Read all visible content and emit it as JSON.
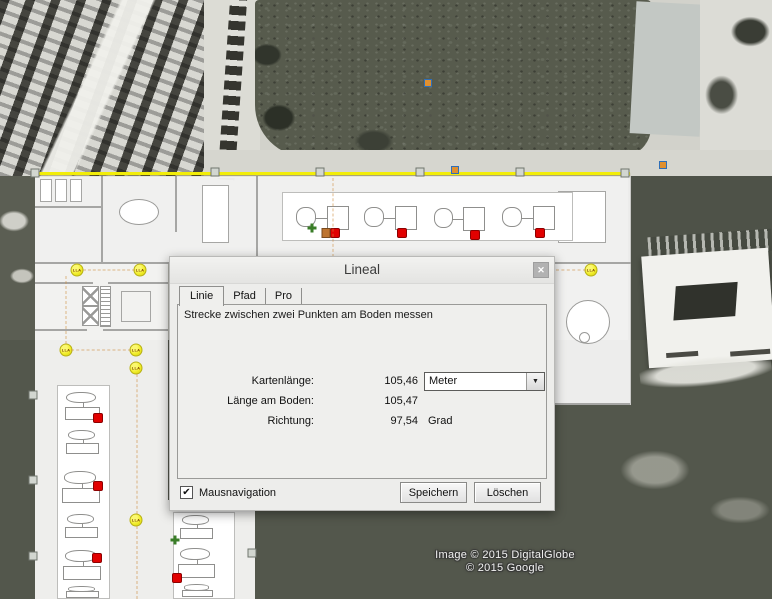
{
  "dialog": {
    "title": "Lineal",
    "close_glyph": "✕",
    "tabs": [
      "Linie",
      "Pfad",
      "Pro"
    ],
    "description": "Strecke zwischen zwei Punkten am Boden messen",
    "fields": [
      {
        "label": "Kartenlänge:",
        "value": "105,46",
        "unit": "Meter"
      },
      {
        "label": "Länge am Boden:",
        "value": "105,47",
        "unit": ""
      },
      {
        "label": "Richtung:",
        "value": "97,54",
        "unit": "Grad"
      }
    ],
    "dropdown_arrow": "▼",
    "checkbox": {
      "label": "Mausnavigation",
      "checked": true,
      "check_glyph": "✔"
    },
    "buttons": [
      "Speichern",
      "Löschen"
    ]
  },
  "map": {
    "attribution": [
      "Image © 2015 DigitalGlobe",
      "© 2015 Google"
    ],
    "ruler_line_color": "#f2ed08",
    "placemark_label": "LLA",
    "annotations": [
      {
        "type": "placemark",
        "label": "LLA",
        "x": 77,
        "y": 270,
        "interactable": true
      },
      {
        "type": "placemark",
        "label": "LLA",
        "x": 140,
        "y": 270,
        "interactable": true
      },
      {
        "type": "placemark",
        "label": "LLA",
        "x": 66,
        "y": 350,
        "interactable": true
      },
      {
        "type": "placemark",
        "label": "LLA",
        "x": 136,
        "y": 350,
        "interactable": true
      },
      {
        "type": "placemark",
        "label": "LLA",
        "x": 136,
        "y": 368,
        "interactable": true
      },
      {
        "type": "placemark",
        "label": "LLA",
        "x": 136,
        "y": 520,
        "interactable": true
      },
      {
        "type": "placemark",
        "label": "LLA",
        "x": 591,
        "y": 270,
        "interactable": true
      },
      {
        "type": "red-dot",
        "x": 335,
        "y": 233
      },
      {
        "type": "red-dot",
        "x": 402,
        "y": 233
      },
      {
        "type": "red-dot",
        "x": 475,
        "y": 235
      },
      {
        "type": "red-dot",
        "x": 540,
        "y": 233
      },
      {
        "type": "red-dot",
        "x": 98,
        "y": 418
      },
      {
        "type": "red-dot",
        "x": 98,
        "y": 486
      },
      {
        "type": "red-dot",
        "x": 97,
        "y": 558
      },
      {
        "type": "red-dot",
        "x": 177,
        "y": 578
      },
      {
        "type": "green-dot",
        "x": 312,
        "y": 228
      },
      {
        "type": "green-dot",
        "x": 175,
        "y": 540
      },
      {
        "type": "orange-dot",
        "x": 326,
        "y": 233
      },
      {
        "type": "blue-dot",
        "x": 428,
        "y": 83
      },
      {
        "type": "blue-dot",
        "x": 455,
        "y": 170
      },
      {
        "type": "blue-dot",
        "x": 663,
        "y": 165
      },
      {
        "type": "handle",
        "x": 35,
        "y": 173,
        "interactable": true
      },
      {
        "type": "handle",
        "x": 215,
        "y": 172,
        "interactable": true
      },
      {
        "type": "handle",
        "x": 320,
        "y": 172,
        "interactable": true
      },
      {
        "type": "handle",
        "x": 420,
        "y": 172,
        "interactable": true
      },
      {
        "type": "handle",
        "x": 520,
        "y": 172,
        "interactable": true
      },
      {
        "type": "handle",
        "x": 625,
        "y": 173,
        "interactable": true
      },
      {
        "type": "handle",
        "x": 33,
        "y": 395,
        "interactable": true
      },
      {
        "type": "handle",
        "x": 33,
        "y": 480,
        "interactable": true
      },
      {
        "type": "handle",
        "x": 33,
        "y": 556,
        "interactable": true
      },
      {
        "type": "handle",
        "x": 252,
        "y": 553,
        "interactable": true
      },
      {
        "type": "dash-h",
        "x": 83,
        "y": 270,
        "len": 52
      },
      {
        "type": "dash-h",
        "x": 71,
        "y": 350,
        "len": 60
      },
      {
        "type": "dash-h",
        "x": 556,
        "y": 270,
        "len": 30
      },
      {
        "type": "dash-v",
        "x": 66,
        "y": 276,
        "len": 68
      },
      {
        "type": "dash-v",
        "x": 137,
        "y": 374,
        "len": 140
      },
      {
        "type": "dash-v",
        "x": 137,
        "y": 526,
        "len": 73
      },
      {
        "type": "dash-v",
        "x": 333,
        "y": 178,
        "len": 84
      }
    ]
  }
}
